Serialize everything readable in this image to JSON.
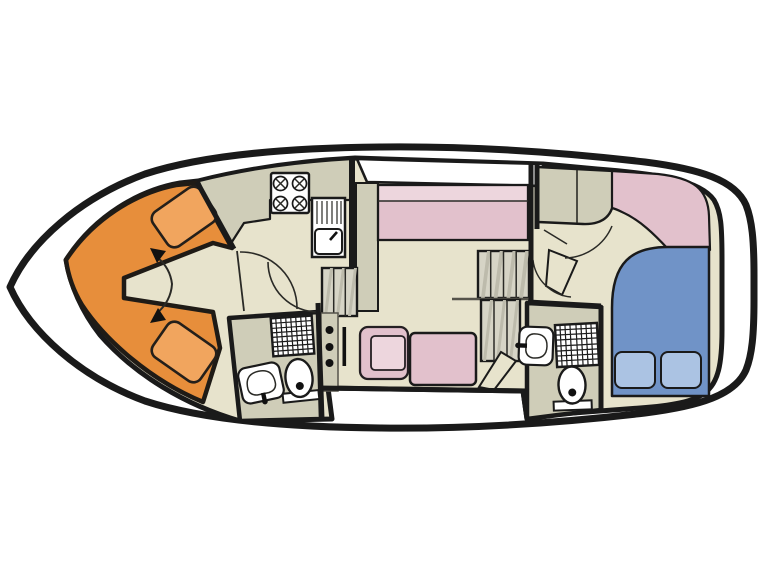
{
  "diagram": {
    "kind": "houseboat floor plan, top-down view, no text labels",
    "palette": {
      "background": "#ffffff",
      "hull": "#ffffff",
      "outline": "#1a1a1a",
      "floor_beige": "#E7E3CC",
      "floor_grey": "#CFCDB8",
      "cabin_orange": "#E78E3B",
      "berth_orange": "#F1A55E",
      "upholstery_pink": "#E2C1CC",
      "upholstery_pink_light": "#EDD6DD",
      "bed_blue": "#7093C7",
      "pillow_blue": "#ABC3E3",
      "stair_tread": "#D6D4C6",
      "stair_shade": "#BDBBAC",
      "deck_white": "#ffffff"
    },
    "rooms": [
      {
        "id": "bow-cabin",
        "label": "V-berth bow cabin"
      },
      {
        "id": "galley",
        "label": "Galley"
      },
      {
        "id": "bathroom-forward",
        "label": "Forward bathroom"
      },
      {
        "id": "salon",
        "label": "Salon with helm"
      },
      {
        "id": "bathroom-aft",
        "label": "Aft bathroom"
      },
      {
        "id": "aft-cabin",
        "label": "Aft double cabin"
      },
      {
        "id": "side-deck",
        "label": "Side deck walkways"
      }
    ],
    "furniture": [
      "twin v-berths",
      "conversion arrows",
      "four-burner stove",
      "sink with drainer",
      "companionway steps",
      "long bench sofa",
      "sideboard",
      "flybridge stairs",
      "handrail",
      "helm console with three gauges",
      "helm lever",
      "helm armchair",
      "salon table bench",
      "door leaves",
      "wardrobe",
      "upholstered headboard",
      "double bed",
      "two pillows",
      "two showers",
      "two toilets",
      "two washbasins"
    ]
  }
}
